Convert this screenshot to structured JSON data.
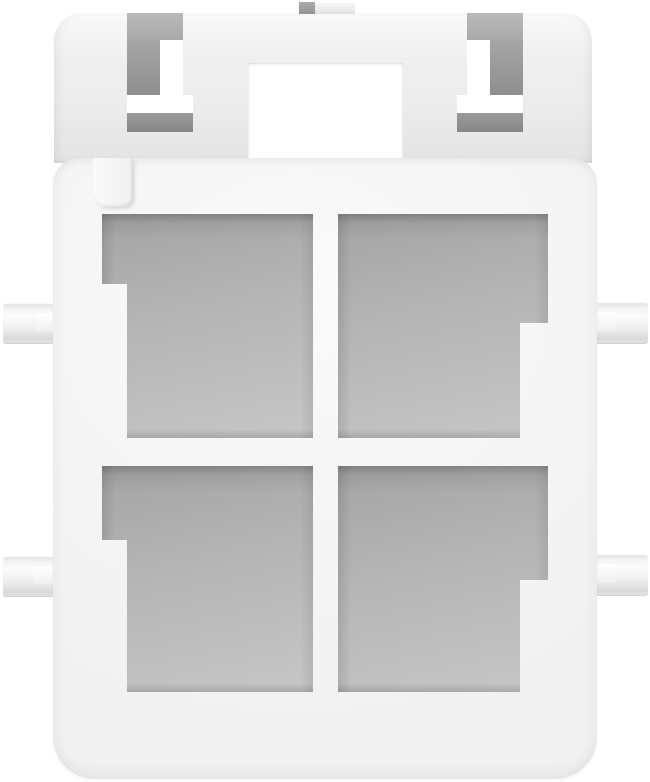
{
  "image": {
    "type": "3d-product-render",
    "subject": "White rectangular 4-cavity electrical connector housing, mating-face view, on plain white background",
    "cavity_count": 4,
    "cavity_layout": "2x2 grid with keyed corner notches",
    "visible_features": [
      "rear-housing-with-two-latch-windows",
      "top-alignment-tab",
      "center-rectangular-window",
      "front-flange",
      "polarization-rib",
      "four-keyed-terminal-cavities",
      "four-side-mounting-tabs"
    ]
  },
  "colors": {
    "bg": "#ffffff",
    "body_light": "#fafafa",
    "body_mid": "#f1f1f1",
    "body_shade": "#e4e4e4",
    "cavity_dark": "#a4a4a4",
    "cavity_mid": "#b5b5b5",
    "cavity_light": "#c6c6c6",
    "slot_gray_light": "#b9b9b9",
    "slot_gray_dark": "#8e8e8e",
    "recess_dark": "#868686",
    "tab_highlight": "#ffffff"
  }
}
